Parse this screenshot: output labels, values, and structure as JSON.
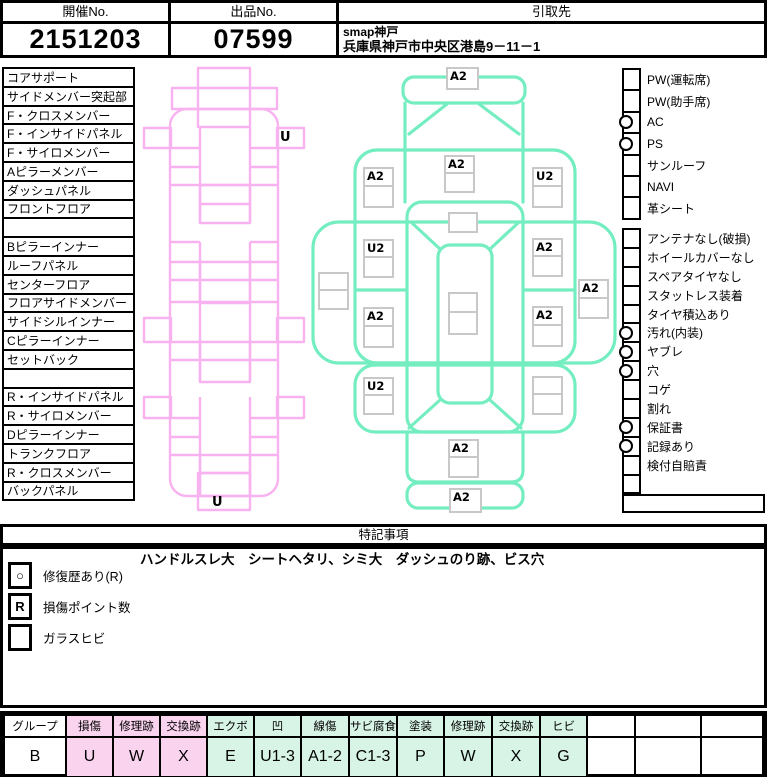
{
  "header": {
    "auction_no_label": "開催No.",
    "auction_no": "2151203",
    "lot_no_label": "出品No.",
    "lot_no": "07599",
    "pickup_label": "引取先",
    "pickup_name": "smap神戸",
    "pickup_address": "兵庫県神戸市中央区港島9－11－1"
  },
  "parts_list": [
    "コアサポート",
    "サイドメンバー突起部",
    "F・クロスメンバー",
    "F・インサイドパネル",
    "F・サイロメンバー",
    "Aピラーメンバー",
    "ダッシュパネル",
    "フロントフロア",
    "",
    "Bピラーインナー",
    "ルーフパネル",
    "センターフロア",
    "フロアサイドメンバー",
    "サイドシルインナー",
    "Cピラーインナー",
    "セットバック",
    "",
    "R・インサイドパネル",
    "R・サイロメンバー",
    "Dピラーインナー",
    "トランクフロア",
    "R・クロスメンバー",
    "バックパネル"
  ],
  "equipment": [
    {
      "label": "PW(運転席)",
      "checked": false
    },
    {
      "label": "PW(助手席)",
      "checked": false
    },
    {
      "label": "AC",
      "checked": true
    },
    {
      "label": "PS",
      "checked": true
    },
    {
      "label": "サンルーフ",
      "checked": false
    },
    {
      "label": "NAVI",
      "checked": false
    },
    {
      "label": "革シート",
      "checked": false
    }
  ],
  "conditions": [
    {
      "label": "アンテナなし(破損)",
      "checked": false
    },
    {
      "label": "ホイールカバーなし",
      "checked": false
    },
    {
      "label": "スペアタイヤなし",
      "checked": false
    },
    {
      "label": "スタットレス装着",
      "checked": false
    },
    {
      "label": "タイヤ積込あり",
      "checked": false
    },
    {
      "label": "汚れ(内装)",
      "checked": true
    },
    {
      "label": "ヤブレ",
      "checked": true
    },
    {
      "label": "穴",
      "checked": true
    },
    {
      "label": "コゲ",
      "checked": false
    },
    {
      "label": "割れ",
      "checked": false
    },
    {
      "label": "保証書",
      "checked": true
    },
    {
      "label": "記録あり",
      "checked": true
    },
    {
      "label": "検付自賠責",
      "checked": false
    },
    {
      "label": "",
      "checked": false
    }
  ],
  "diagram": {
    "frame_labels": [
      {
        "label": "U"
      },
      {
        "label": "U"
      }
    ],
    "markers": [
      {
        "part": "front-bumper",
        "label": "A2"
      },
      {
        "part": "hood",
        "label": "A2"
      },
      {
        "part": "front-left-fender",
        "label": "A2"
      },
      {
        "part": "front-right-fender",
        "label": "U2"
      },
      {
        "part": "cowl",
        "label": ""
      },
      {
        "part": "left-front-door",
        "label": "U2"
      },
      {
        "part": "right-front-door",
        "label": "A2"
      },
      {
        "part": "left-side-sill",
        "label": ""
      },
      {
        "part": "right-side",
        "label": "A2"
      },
      {
        "part": "roof",
        "label": ""
      },
      {
        "part": "left-rear-door",
        "label": "A2"
      },
      {
        "part": "right-rear-door",
        "label": "A2"
      },
      {
        "part": "left-rear-fender",
        "label": "U2"
      },
      {
        "part": "right-rear-fender",
        "label": ""
      },
      {
        "part": "trunk",
        "label": "A2"
      },
      {
        "part": "rear-bumper",
        "label": "A2"
      }
    ]
  },
  "remarks": {
    "title": "特記事項",
    "note": "ハンドルスレ大　シートヘタリ、シミ大　ダッシュのり跡、ビス穴",
    "legend": [
      {
        "symbol": "○",
        "label": "修復歴あり(R)"
      },
      {
        "symbol": "R",
        "label": "損傷ポイント数"
      },
      {
        "symbol": "",
        "label": "ガラスヒビ"
      }
    ]
  },
  "grade_table": {
    "headers": [
      "グループ",
      "損傷",
      "修理跡",
      "交換跡",
      "エクボ",
      "凹",
      "線傷",
      "サビ腐食",
      "塗装",
      "修理跡",
      "交換跡",
      "ヒビ",
      "",
      "",
      ""
    ],
    "values": [
      "B",
      "U",
      "W",
      "X",
      "E",
      "U1-3",
      "A1-2",
      "C1-3",
      "P",
      "W",
      "X",
      "G",
      "",
      "",
      ""
    ]
  },
  "colors": {
    "frame_pink": "#F8B2EF",
    "body_green": "#74EEC1",
    "cell_pink": "#FAD4EE",
    "cell_mint": "#D7F4E6"
  }
}
